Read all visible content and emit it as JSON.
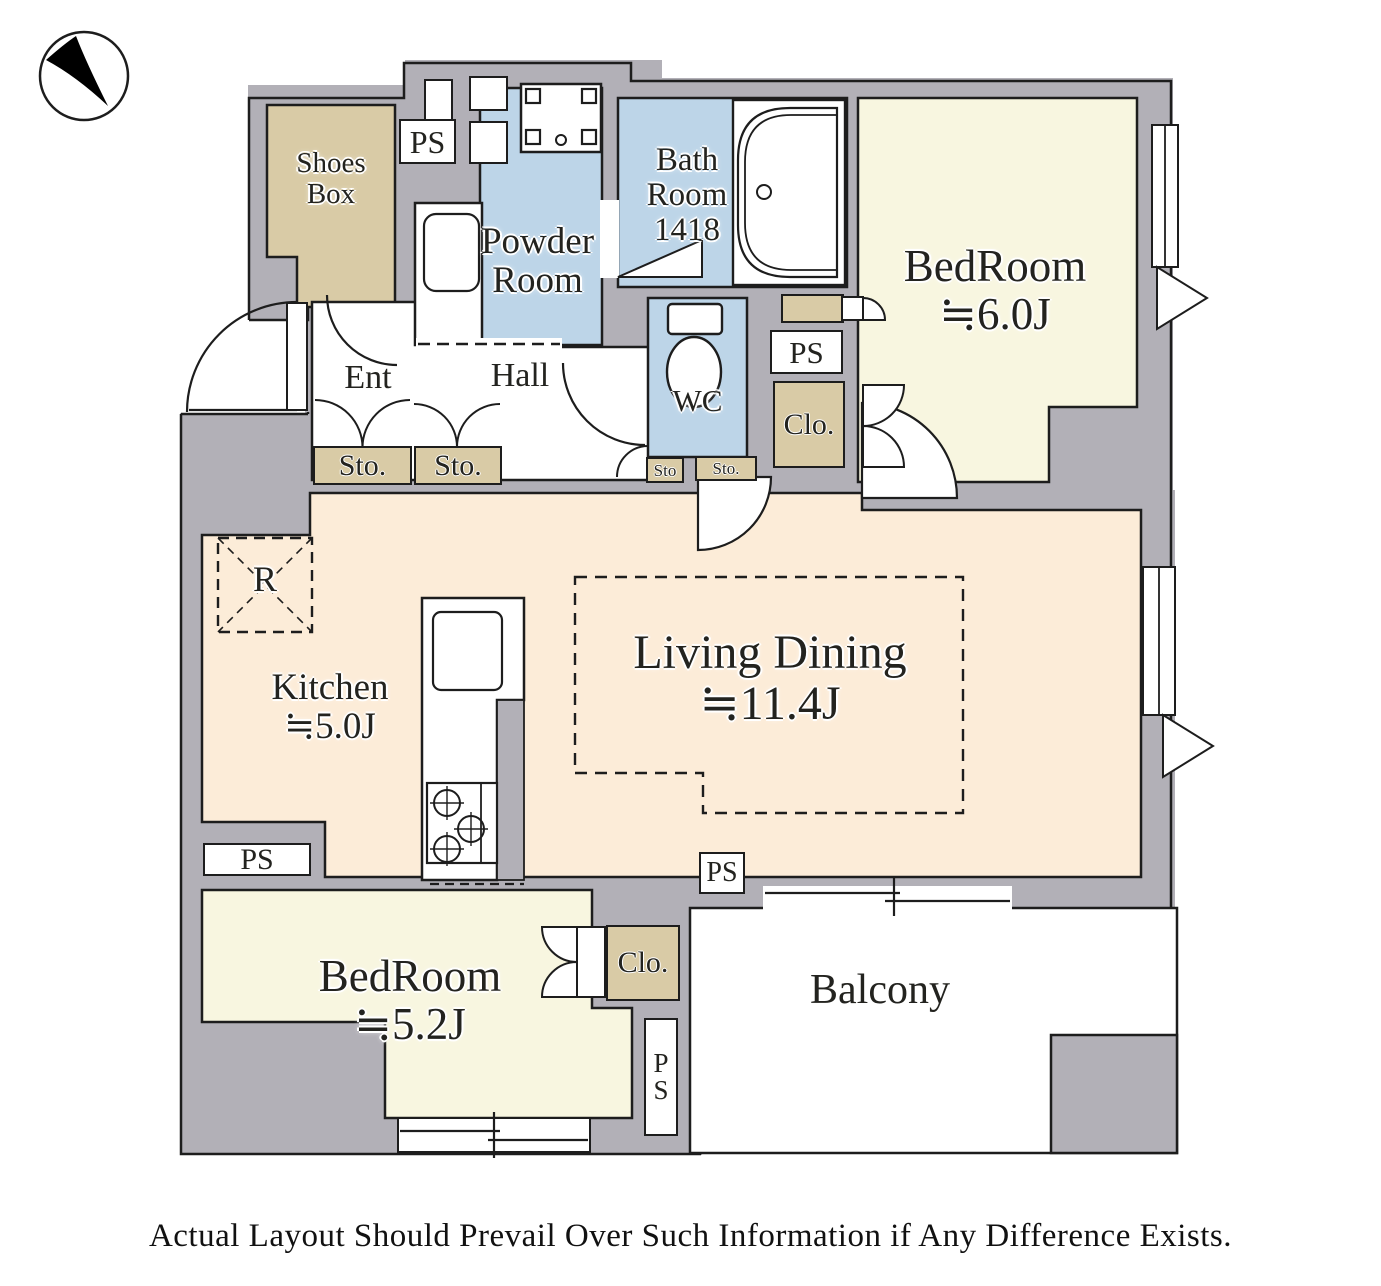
{
  "floorplan": {
    "rooms": {
      "shoes_box": {
        "line1": "Shoes",
        "line2": "Box"
      },
      "powder_room": {
        "line1": "Powder",
        "line2": "Room"
      },
      "bath_room": {
        "line1": "Bath",
        "line2": "Room",
        "size": "1418"
      },
      "bedroom_main": {
        "name": "BedRoom",
        "size": "≒6.0J"
      },
      "entrance": {
        "label": "Ent"
      },
      "hall": {
        "label": "Hall"
      },
      "wc": {
        "label": "WC"
      },
      "kitchen": {
        "name": "Kitchen",
        "size": "≒5.0J"
      },
      "living_dining": {
        "name": "Living Dining",
        "size": "≒11.4J"
      },
      "bedroom_second": {
        "name": "BedRoom",
        "size": "≒5.2J"
      },
      "balcony": {
        "label": "Balcony"
      },
      "refrigerator": {
        "label": "R"
      }
    },
    "fixtures": {
      "pipe_space": "PS",
      "ps_vertical": [
        "P",
        "S"
      ],
      "storage": "Sto.",
      "storage_small": "Sto",
      "closet": "Clo."
    },
    "compass": {
      "icon": "north-arrow"
    },
    "colors": {
      "wall": "#b2b0b7",
      "wet_area": "#bdd5e8",
      "bedroom": "#f8f6e0",
      "ldk": "#fcecd8",
      "storage_tan": "#d9cba6",
      "outline": "#1d1d1d"
    },
    "disclaimer": "Actual Layout Should Prevail Over Such Information if Any Difference Exists."
  }
}
